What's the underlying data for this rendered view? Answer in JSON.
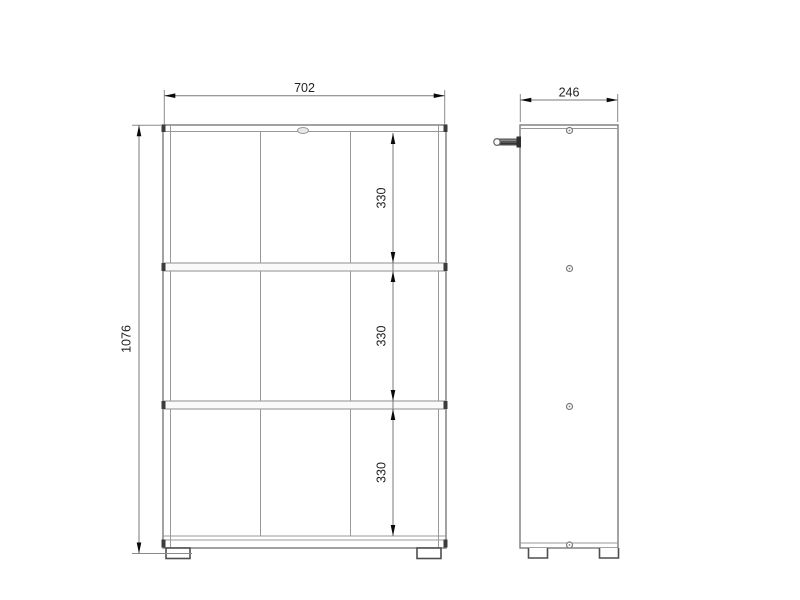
{
  "drawing": {
    "kind": "cabinet dimension drawing",
    "views": {
      "front": {
        "width_mm": "702",
        "height_mm": "1076",
        "section_heights_mm": [
          "330",
          "330",
          "330"
        ],
        "compartment_rows": 3,
        "compartment_columns": 3
      },
      "side": {
        "depth_mm": "246"
      }
    },
    "colors": {
      "background": "#ffffff",
      "body_outline": "#7b7b7b",
      "inner_lines": "#989898",
      "dimension_lines": "#787878",
      "arrows": "#0a0a0a",
      "label_text": "#1f1f1f",
      "connector_marks": "#3c3c3c"
    }
  }
}
